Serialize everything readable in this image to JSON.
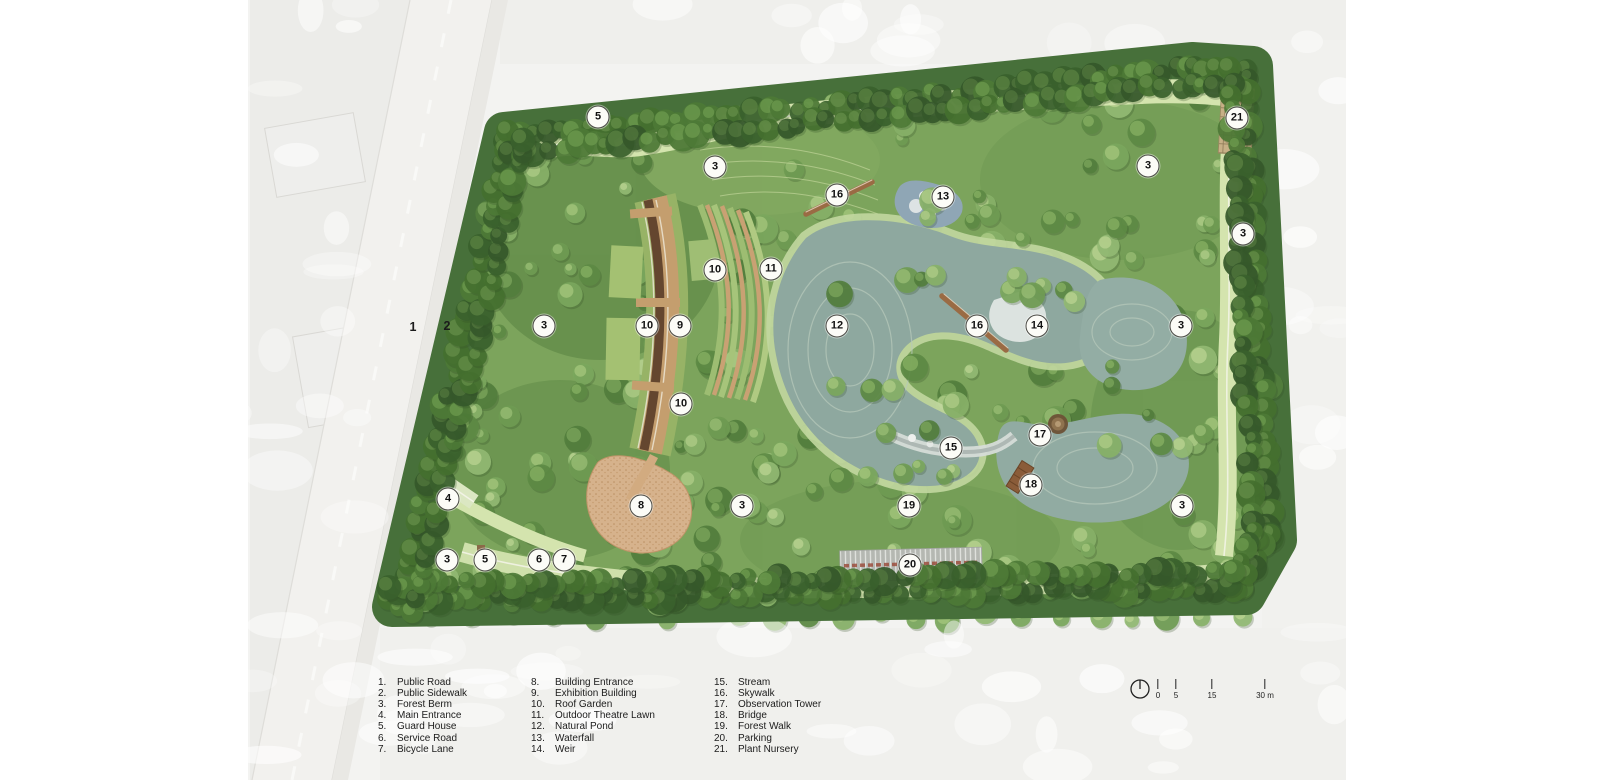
{
  "plan": {
    "kind": "park-master-plan-rendering",
    "markers": [
      {
        "n": "1",
        "x": 413,
        "y": 327,
        "circled": false
      },
      {
        "n": "2",
        "x": 447,
        "y": 326,
        "circled": false
      },
      {
        "n": "3",
        "x": 715,
        "y": 167,
        "circled": true
      },
      {
        "n": "3",
        "x": 1148,
        "y": 166,
        "circled": true
      },
      {
        "n": "3",
        "x": 1243,
        "y": 234,
        "circled": true
      },
      {
        "n": "3",
        "x": 544,
        "y": 326,
        "circled": true
      },
      {
        "n": "3",
        "x": 1181,
        "y": 326,
        "circled": true
      },
      {
        "n": "3",
        "x": 447,
        "y": 560,
        "circled": true
      },
      {
        "n": "3",
        "x": 742,
        "y": 506,
        "circled": true
      },
      {
        "n": "3",
        "x": 1182,
        "y": 506,
        "circled": true
      },
      {
        "n": "4",
        "x": 448,
        "y": 499,
        "circled": true
      },
      {
        "n": "5",
        "x": 598,
        "y": 117,
        "circled": true
      },
      {
        "n": "5",
        "x": 485,
        "y": 560,
        "circled": true
      },
      {
        "n": "6",
        "x": 539,
        "y": 560,
        "circled": true
      },
      {
        "n": "7",
        "x": 564,
        "y": 560,
        "circled": true
      },
      {
        "n": "8",
        "x": 641,
        "y": 506,
        "circled": true
      },
      {
        "n": "9",
        "x": 680,
        "y": 326,
        "circled": true
      },
      {
        "n": "10",
        "x": 715,
        "y": 270,
        "circled": true
      },
      {
        "n": "10",
        "x": 647,
        "y": 326,
        "circled": true
      },
      {
        "n": "10",
        "x": 681,
        "y": 404,
        "circled": true
      },
      {
        "n": "11",
        "x": 771,
        "y": 269,
        "circled": true
      },
      {
        "n": "12",
        "x": 837,
        "y": 326,
        "circled": true
      },
      {
        "n": "13",
        "x": 943,
        "y": 197,
        "circled": true
      },
      {
        "n": "14",
        "x": 1037,
        "y": 326,
        "circled": true
      },
      {
        "n": "15",
        "x": 951,
        "y": 448,
        "circled": true
      },
      {
        "n": "16",
        "x": 837,
        "y": 195,
        "circled": true
      },
      {
        "n": "16",
        "x": 977,
        "y": 326,
        "circled": true
      },
      {
        "n": "17",
        "x": 1040,
        "y": 435,
        "circled": true
      },
      {
        "n": "18",
        "x": 1031,
        "y": 485,
        "circled": true
      },
      {
        "n": "19",
        "x": 909,
        "y": 506,
        "circled": true
      },
      {
        "n": "20",
        "x": 910,
        "y": 565,
        "circled": true
      },
      {
        "n": "21",
        "x": 1237,
        "y": 118,
        "circled": true
      }
    ]
  },
  "legend": {
    "columns": [
      [
        {
          "num": "1.",
          "label": "Public Road"
        },
        {
          "num": "2.",
          "label": "Public Sidewalk"
        },
        {
          "num": "3.",
          "label": "Forest Berm"
        },
        {
          "num": "4.",
          "label": "Main Entrance"
        },
        {
          "num": "5.",
          "label": "Guard House"
        },
        {
          "num": "6.",
          "label": "Service Road"
        },
        {
          "num": "7.",
          "label": "Bicycle Lane"
        }
      ],
      [
        {
          "num": "8.",
          "label": "Building Entrance"
        },
        {
          "num": "9.",
          "label": "Exhibition Building"
        },
        {
          "num": "10.",
          "label": "Roof Garden"
        },
        {
          "num": "11.",
          "label": "Outdoor Theatre Lawn"
        },
        {
          "num": "12.",
          "label": "Natural Pond"
        },
        {
          "num": "13.",
          "label": "Waterfall"
        },
        {
          "num": "14.",
          "label": "Weir"
        }
      ],
      [
        {
          "num": "15.",
          "label": "Stream"
        },
        {
          "num": "16.",
          "label": "Skywalk"
        },
        {
          "num": "17.",
          "label": "Observation Tower"
        },
        {
          "num": "18.",
          "label": "Bridge"
        },
        {
          "num": "19.",
          "label": "Forest Walk"
        },
        {
          "num": "20.",
          "label": "Parking"
        },
        {
          "num": "21.",
          "label": "Plant Nursery"
        }
      ]
    ]
  },
  "scale_bar": {
    "ticks": [
      {
        "label": "0",
        "x": 1158
      },
      {
        "label": "5",
        "x": 1176
      },
      {
        "label": "15",
        "x": 1212
      },
      {
        "label": "30 m",
        "x": 1265
      }
    ]
  },
  "colors": {
    "forest_dark": "#3f6630",
    "forest_mid": "#6f9b52",
    "forest_light": "#8db069",
    "meadow": "#d3e3ad",
    "pond": "#8ea89f",
    "pond_ring": "#b6c8ba",
    "walk_tan": "#c49e6e",
    "roof_walk": "#5e432f",
    "roof_green": "#94b164",
    "plaza": "#d6b28c",
    "parking": "#b4b7b1",
    "car_red": "#9c4f3e",
    "nursery": "#c5ae84",
    "marker_fill": "#fcfcf7",
    "marker_stroke": "#4b4b45"
  }
}
